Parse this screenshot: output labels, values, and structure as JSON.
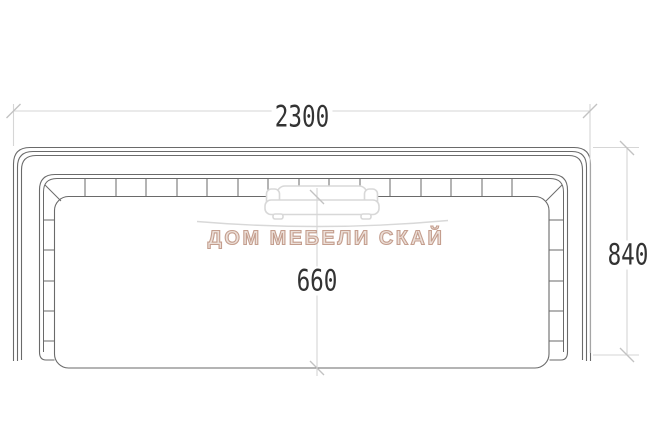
{
  "drawing": {
    "dimensions": {
      "overall_width": "2300",
      "overall_depth": "840",
      "seat_depth": "660"
    }
  },
  "watermark": {
    "brand_text": "ДОМ МЕБЕЛИ СКАЙ",
    "logo_icon": "sofa-icon"
  },
  "colors": {
    "background": "#ffffff",
    "object_line": "#6a6a6a",
    "dimension_line": "#d6d6d6",
    "tick": "#c2c2c2",
    "dimension_text": "#333333",
    "watermark_line": "#d8d8d8",
    "watermark_text_fill": "#ecdfd8",
    "watermark_text_stroke": "#c49e8e"
  }
}
